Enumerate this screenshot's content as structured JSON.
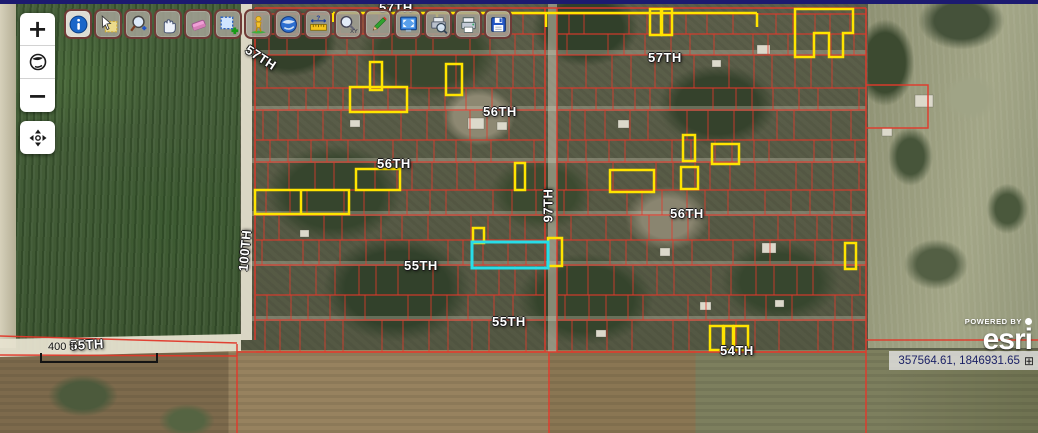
{
  "colors": {
    "parcel_red": "#e0392b",
    "highlight_yellow": "#ffe400",
    "selection_cyan": "#27dde8",
    "road_white": "#e6e1cf"
  },
  "toolbar": {
    "buttons": [
      {
        "name": "identify",
        "icon": "info-icon",
        "active": true
      },
      {
        "name": "select-features",
        "icon": "select-cursor-icon"
      },
      {
        "name": "zoom-in-tool",
        "icon": "magnifier-plus-icon"
      },
      {
        "name": "pan",
        "icon": "hand-icon"
      },
      {
        "name": "erase",
        "icon": "eraser-icon"
      },
      {
        "name": "add-to-selection",
        "icon": "marquee-plus-icon"
      },
      {
        "name": "street-view",
        "icon": "pegman-icon"
      },
      {
        "name": "google-earth",
        "icon": "globe-icon"
      },
      {
        "name": "measure",
        "icon": "ruler-icon"
      },
      {
        "name": "zoom-to-coordinates",
        "icon": "magnifier-xy-icon"
      },
      {
        "name": "draw",
        "icon": "pencil-icon"
      },
      {
        "name": "full-extent",
        "icon": "monitor-arrows-icon"
      },
      {
        "name": "print-preview",
        "icon": "printer-magnifier-icon"
      },
      {
        "name": "print",
        "icon": "printer-icon"
      },
      {
        "name": "save",
        "icon": "floppy-icon"
      }
    ]
  },
  "zoom_controls": {
    "zoom_in": "+",
    "zoom_out": "−"
  },
  "icons": {
    "measure_glyph": "?",
    "xy_glyph": "XY",
    "expand_glyph": "⊞"
  },
  "map": {
    "street_labels": [
      {
        "text": "57TH",
        "left": 379,
        "top": 0,
        "rot": 0
      },
      {
        "text": "57TH",
        "left": 244,
        "top": 50,
        "rot": 33
      },
      {
        "text": "57TH",
        "left": 648,
        "top": 50,
        "rot": 0
      },
      {
        "text": "56TH",
        "left": 483,
        "top": 104,
        "rot": 0
      },
      {
        "text": "56TH",
        "left": 377,
        "top": 156,
        "rot": 0
      },
      {
        "text": "56TH",
        "left": 670,
        "top": 206,
        "rot": 0
      },
      {
        "text": "55TH",
        "left": 404,
        "top": 258,
        "rot": 0
      },
      {
        "text": "55TH",
        "left": 492,
        "top": 314,
        "rot": 0
      },
      {
        "text": "55TH",
        "left": 70,
        "top": 337,
        "rot": -3
      },
      {
        "text": "54TH",
        "left": 720,
        "top": 343,
        "rot": 0
      },
      {
        "text": "97TH",
        "left": 531,
        "top": 198,
        "rot": -90
      },
      {
        "text": "100TH",
        "left": 224,
        "top": 243,
        "rot": -85
      }
    ],
    "scale_bar": {
      "distance_label": "400 ft"
    },
    "coordinates": {
      "value": "357564.61, 1846931.65"
    },
    "attribution": {
      "powered_by": "POWERED BY",
      "logo_text": "esri"
    }
  }
}
